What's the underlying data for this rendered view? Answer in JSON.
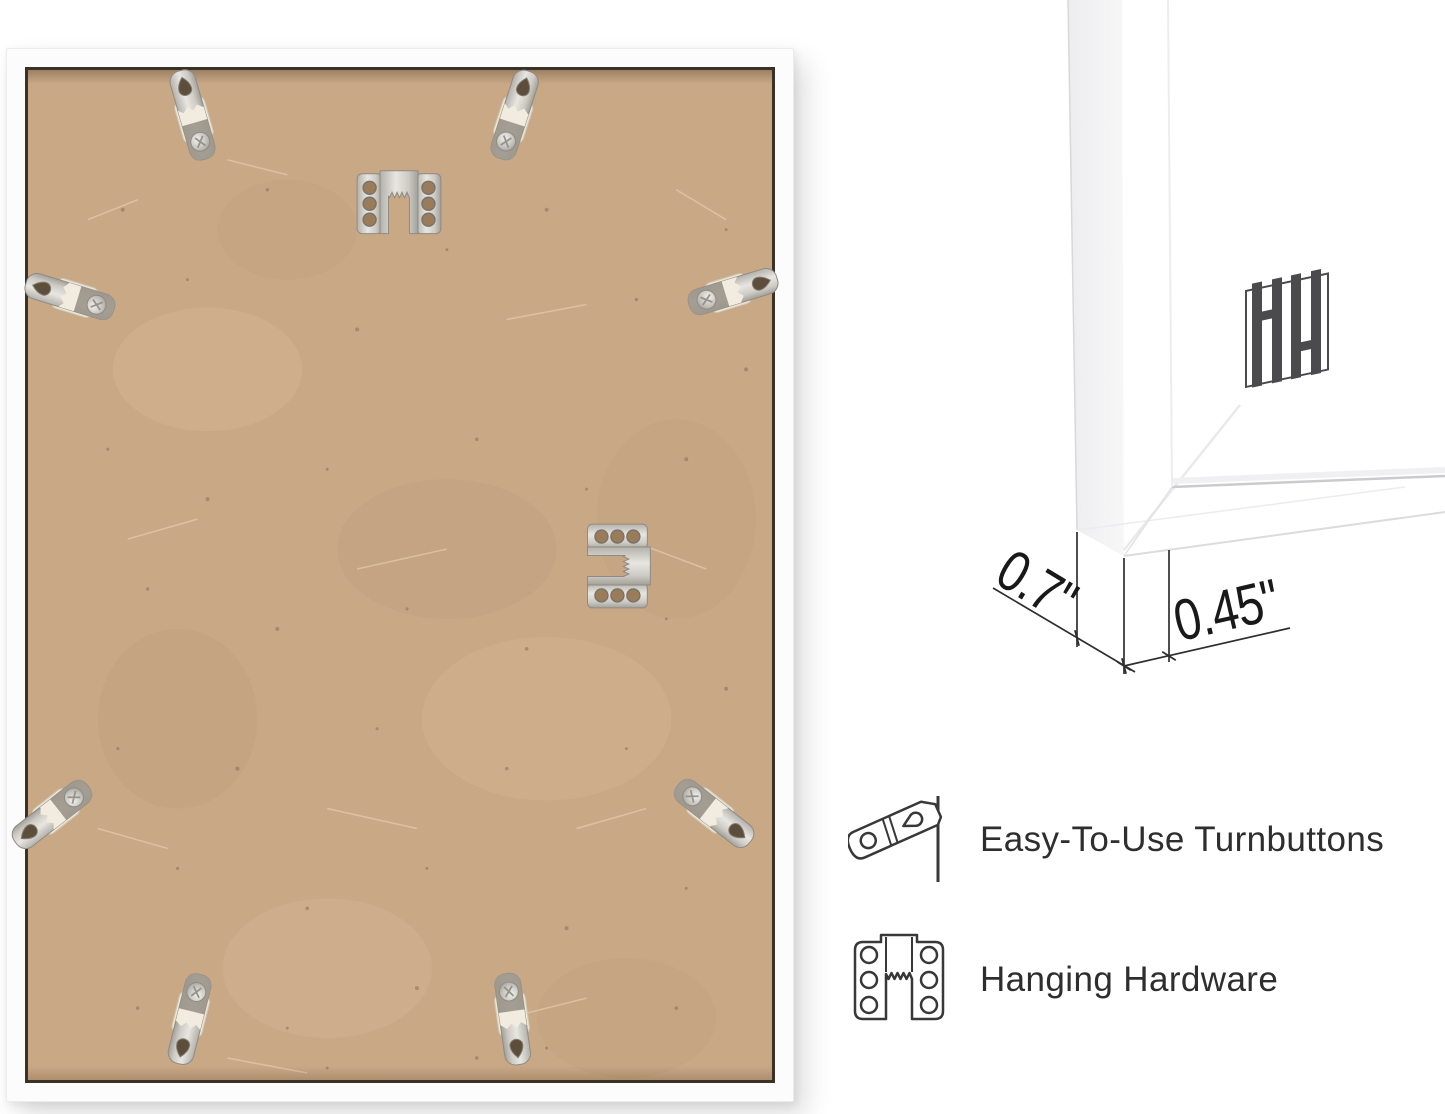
{
  "back_photo": {
    "alt": "Back of white frame with MDF backing board",
    "board_color": "#c9a886",
    "frame_color": "#fcfcfd",
    "turnbutton_count": 8,
    "sawtooth_hanger_count": 2
  },
  "corner_photo": {
    "alt": "Front corner of white frame",
    "logo_icon": "hh-monogram-logo",
    "logo_color": "#4b4b4d"
  },
  "dimensions": {
    "depth": "0.7\"",
    "face_width": "0.45\""
  },
  "features": [
    {
      "icon": "turnbutton-icon",
      "label": "Easy-To-Use Turnbuttons"
    },
    {
      "icon": "hanging-hardware-icon",
      "label": "Hanging Hardware"
    }
  ],
  "colors": {
    "metal": "#c9c6c0",
    "outline": "#383838",
    "text": "#2e2e2e",
    "seam": "#3a3227"
  }
}
